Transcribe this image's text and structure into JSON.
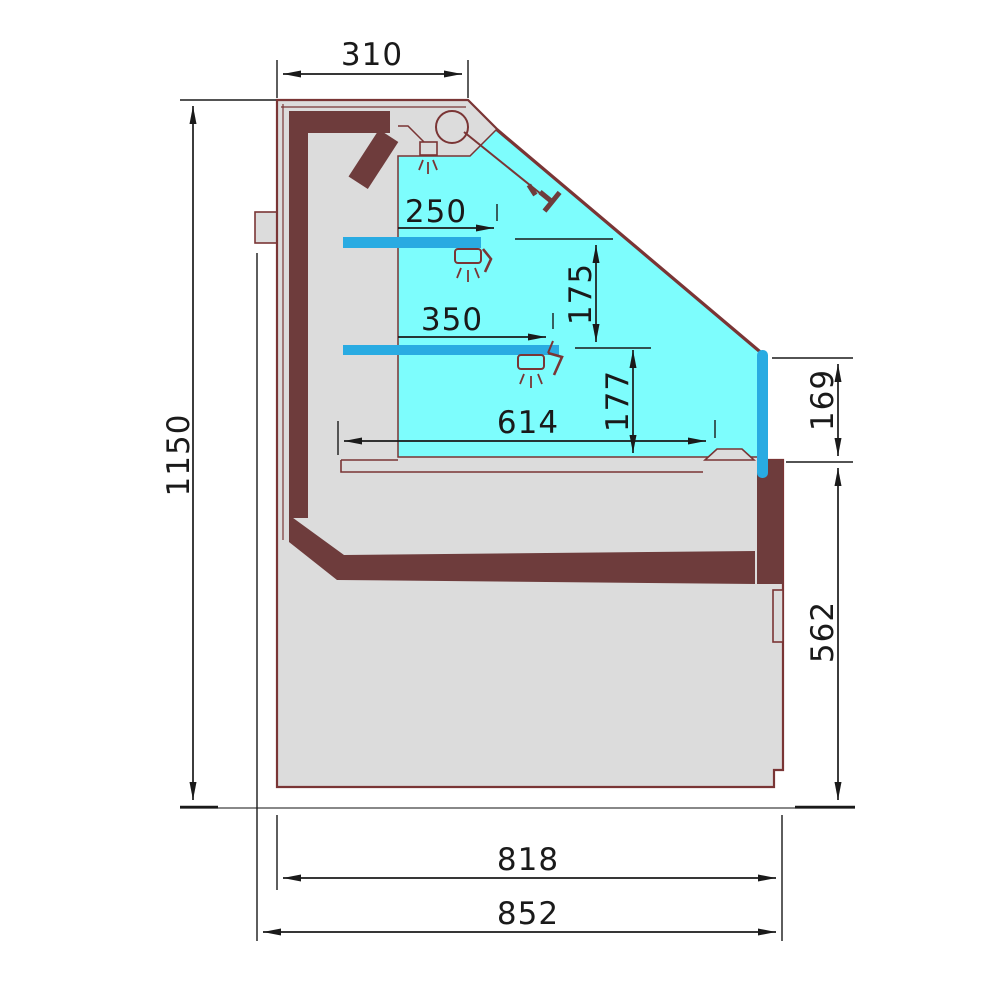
{
  "dimensions": {
    "canopy_depth": {
      "label": "310"
    },
    "overall_height": {
      "label": "1150"
    },
    "upper_shelf_depth": {
      "label": "250"
    },
    "lower_shelf_depth": {
      "label": "350"
    },
    "shelf_spacing": {
      "label": "175"
    },
    "shelf_to_deck": {
      "label": "177"
    },
    "display_deck_depth": {
      "label": "614"
    },
    "front_glass_edge": {
      "label": "169"
    },
    "base_height": {
      "label": "562"
    },
    "body_depth": {
      "label": "818"
    },
    "overall_depth": {
      "label": "852"
    }
  },
  "colors": {
    "body_fill": "#dcdcdc",
    "insulation_fill": "#6e3c3c",
    "outline_stroke": "#7a3535",
    "display_air": "#7dfdfd",
    "shelf_blue": "#29abe2",
    "dimension_ink": "#1a1a1a",
    "floor_line": "#888888",
    "background": "#ffffff"
  }
}
